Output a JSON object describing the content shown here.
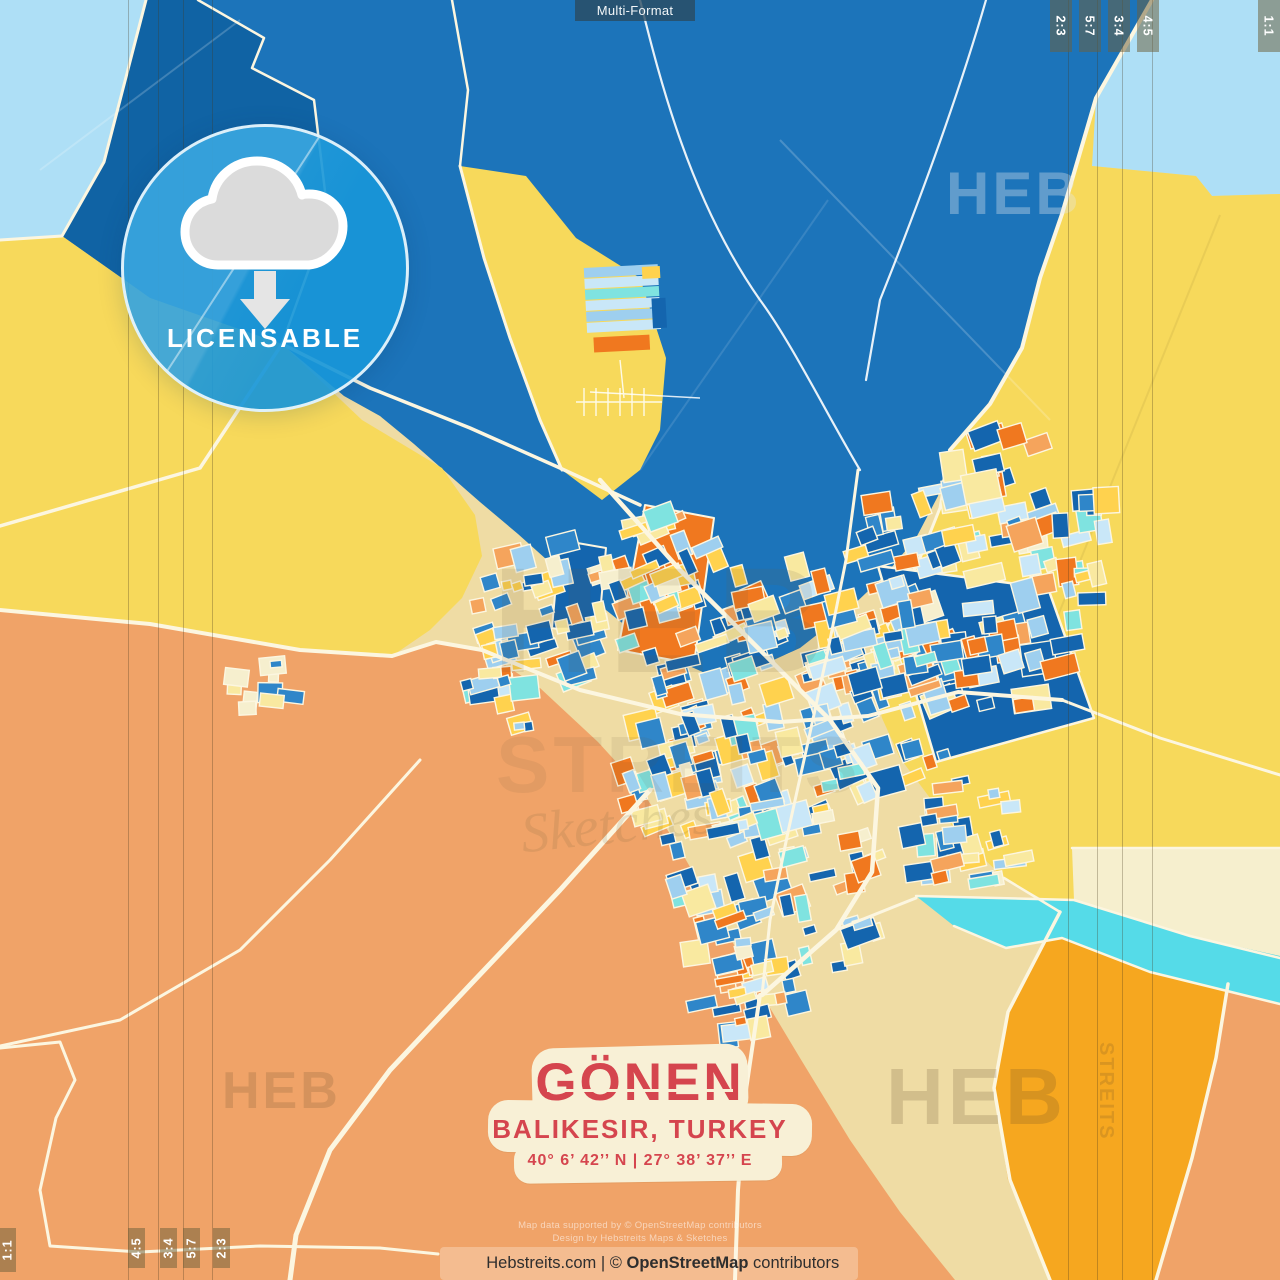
{
  "product": {
    "format_label": "Multi-Format"
  },
  "format_tabs": {
    "top_right": [
      "2:3",
      "5:7",
      "3:4",
      "4:5"
    ],
    "top_right_corner": "1:1",
    "bottom_left": [
      "4:5",
      "3:4",
      "5:7",
      "2:3"
    ],
    "bottom_left_corner": "1:1"
  },
  "badge": {
    "label": "LICENSABLE"
  },
  "title_card": {
    "city": "GÖNEN",
    "region": "BALIKESIR, TURKEY",
    "coordinates": "40°  6’  42’’ N  |  27°  38’  37’’ E"
  },
  "attribution": {
    "line1": "Map data supported by © OpenStreetMap contributors",
    "line2": "Design by Hebstreits Maps & Sketches"
  },
  "footer": {
    "site": "Hebstreits.com",
    "separator": " | © ",
    "osm": "OpenStreetMap",
    "suffix": " contributors"
  },
  "watermarks": {
    "brand": "HEB",
    "brand2": "STREITS",
    "script": "Sketches"
  },
  "map_colors": {
    "tan": "#EFDCA4",
    "light_blue": "#AEDFF6",
    "blue_dark": "#1063A4",
    "blue_main": "#1C74BA",
    "yellow": "#F7D95B",
    "salmon": "#F0A368",
    "cyan": "#55DBE8",
    "amber": "#F6A71F",
    "cream": "#F6EFCE",
    "road": "#FCF6E0",
    "road_white": "#FFFFFF",
    "parcel_blue_dark": "#1465AE",
    "parcel_blue": "#2F86C9",
    "parcel_sky": "#9ECFEF",
    "parcel_pale": "#C9E7F8",
    "parcel_cyan": "#7FE3E0",
    "parcel_pale_yellow": "#F9E9A0",
    "parcel_yellow": "#FFD24E",
    "parcel_orange": "#F0781F",
    "parcel_salmon": "#F5A45C",
    "parcel_cream": "#F6EFCE"
  }
}
